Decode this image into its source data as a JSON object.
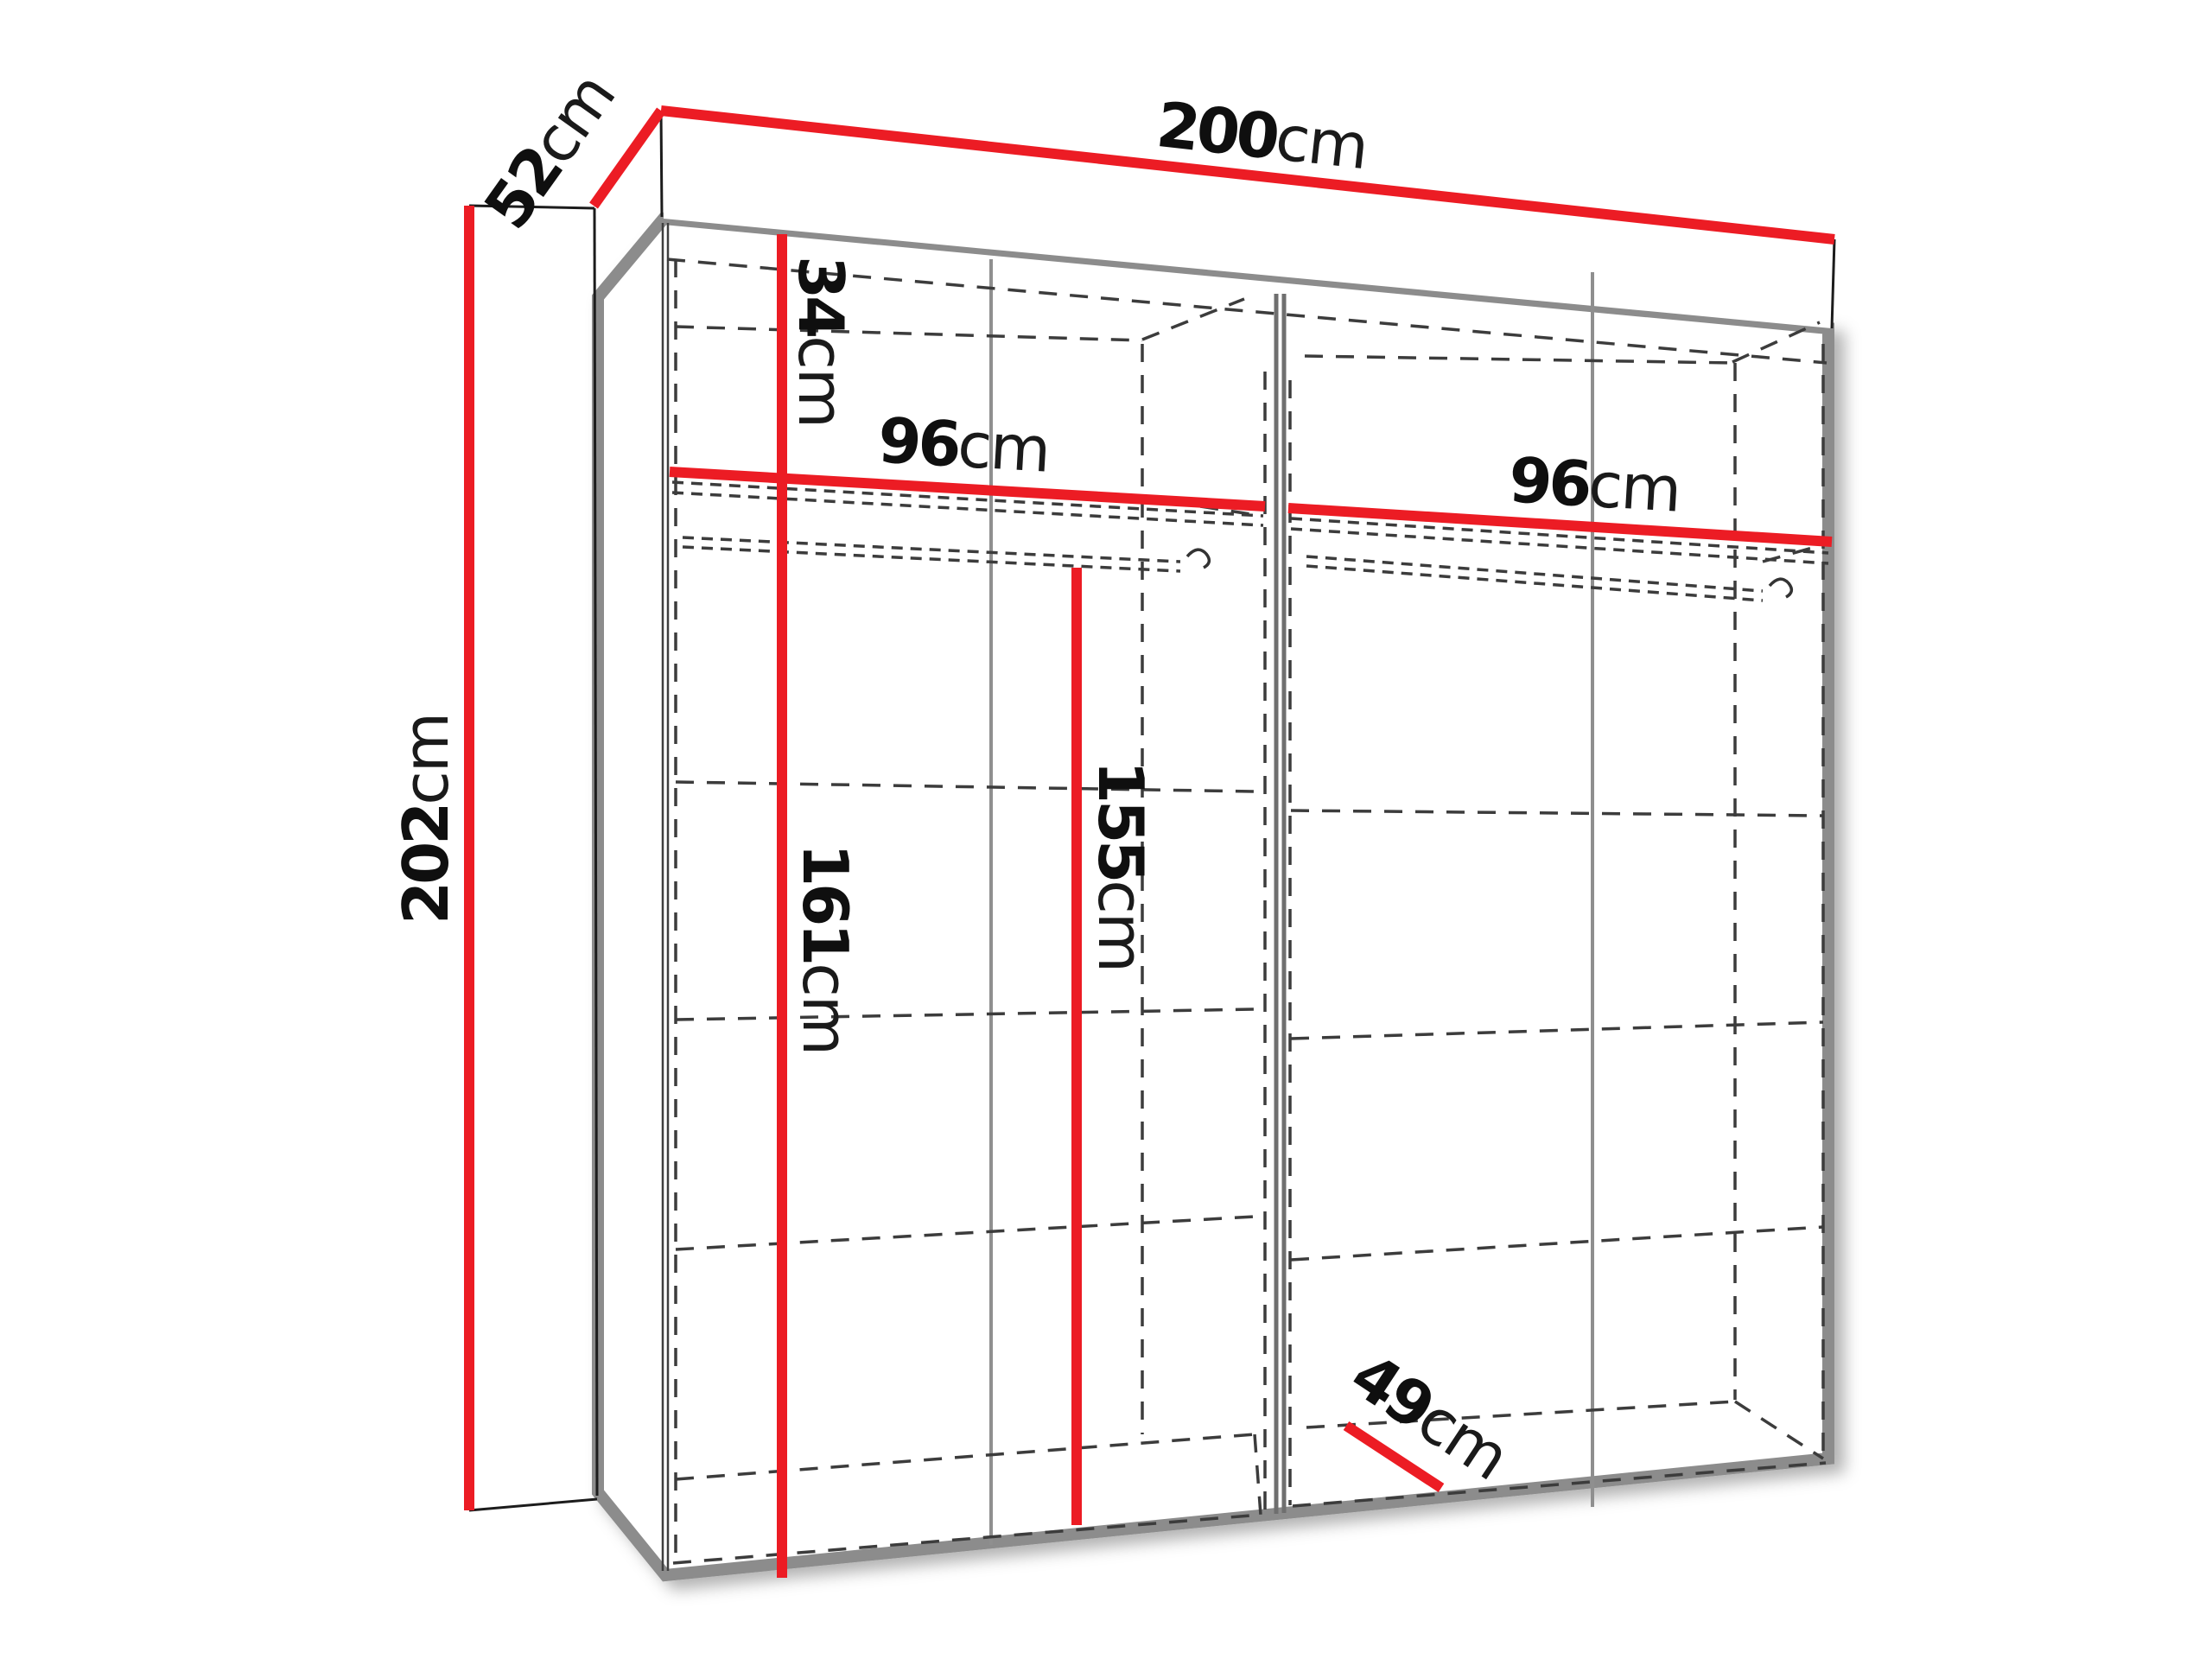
{
  "diagram": {
    "title": "wardrobe-dimension-diagram",
    "dimensions": {
      "total_width": {
        "value": "200",
        "unit": "cm"
      },
      "total_depth": {
        "value": "52",
        "unit": "cm"
      },
      "total_height": {
        "value": "202",
        "unit": "cm"
      },
      "top_shelf_height": {
        "value": "34",
        "unit": "cm"
      },
      "left_section_width": {
        "value": "96",
        "unit": "cm"
      },
      "right_section_width": {
        "value": "96",
        "unit": "cm"
      },
      "left_inner_height": {
        "value": "161",
        "unit": "cm"
      },
      "hanging_height": {
        "value": "155",
        "unit": "cm"
      },
      "inner_depth": {
        "value": "49",
        "unit": "cm"
      }
    },
    "colors": {
      "dimension_line": "#ec1c24",
      "frame": "#8c8c8c",
      "hidden_line": "#3c3c3c",
      "label": "#0f0f0f",
      "background": "#ffffff"
    }
  }
}
